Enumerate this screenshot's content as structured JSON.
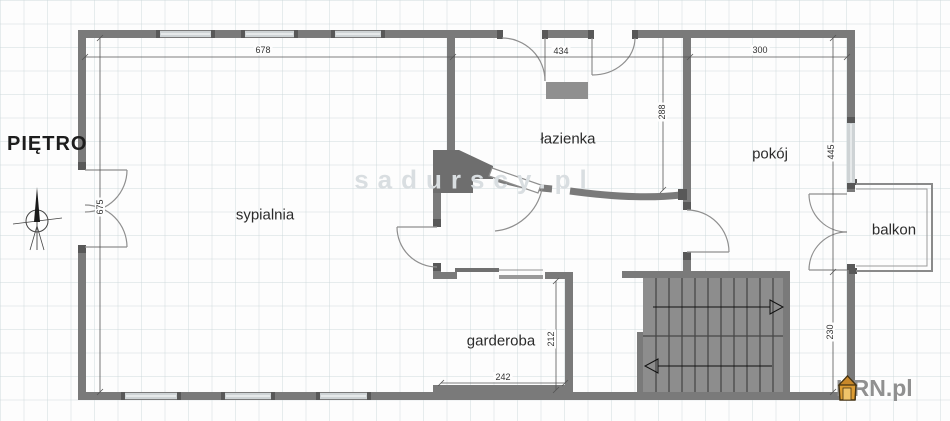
{
  "plan": {
    "floor_label": "PIĘTRO",
    "rooms": {
      "sypialnia": "sypialnia",
      "lazienka": "łazienka",
      "pokoj": "pokój",
      "balkon": "balkon",
      "garderoba": "garderoba"
    },
    "dimensions": {
      "sypialnia_width": "678",
      "lazienka_width": "434",
      "pokoj_width": "300",
      "left_wall_height": "675",
      "lazienka_height": "288",
      "pokoj_height": "445",
      "garderoba_height": "212",
      "garderoba_width": "242",
      "stair_hall_height": "230"
    }
  },
  "branding": {
    "watermark": "sadurscy.pl",
    "logo_text": "KRN.pl"
  },
  "colors": {
    "wall": "#7a7a7a",
    "wall_post": "#585858",
    "window_fill": "#ced3d5",
    "stairs_fill": "#8d8d8d",
    "watermark_gray": "#d9dee1",
    "logo_orange": "#dd9c33",
    "logo_text_gray": "#909090"
  }
}
